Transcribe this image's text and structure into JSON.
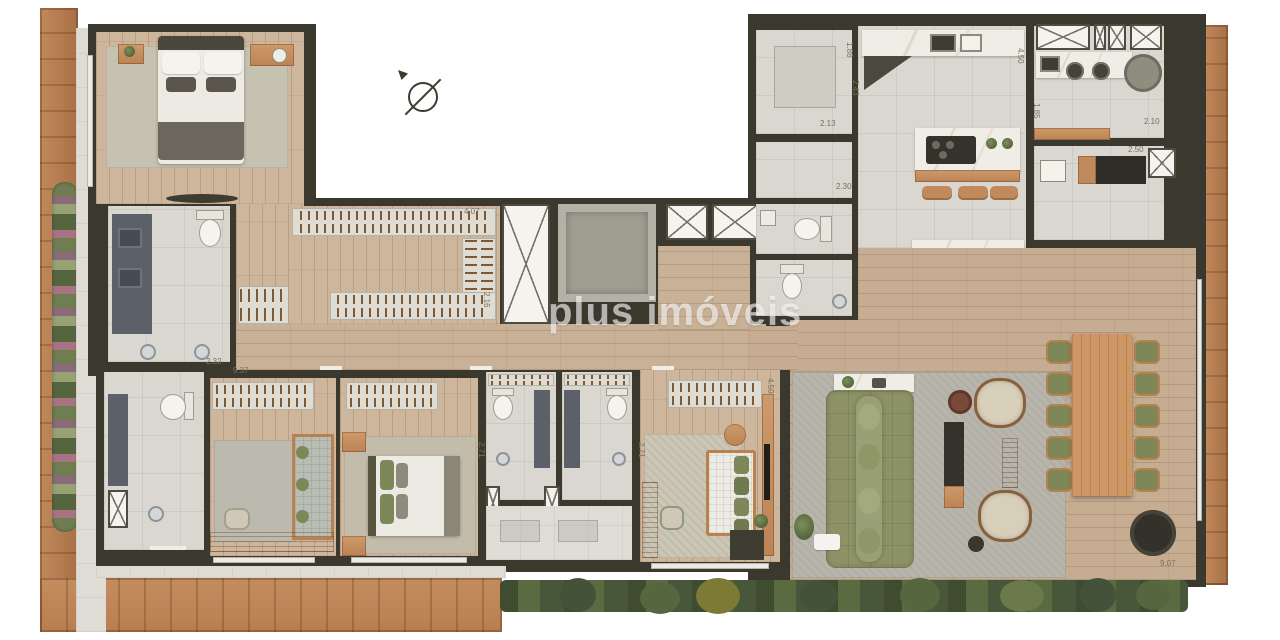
{
  "watermark": {
    "text": "plus imóveis"
  },
  "icons": {
    "north_arrow": "north-arrow"
  },
  "colors": {
    "deck_wood": "#b67c50",
    "wall": "#3b382d",
    "wood_floor": "#cdb69c",
    "tile": "#d9d7cf",
    "sofa_green": "#8d9367",
    "rug_gray": "#b7b5ac",
    "marble": "#efede5",
    "plant_green": "#55663f",
    "watermark_white": "rgba(255,255,255,0.62)"
  },
  "dims": [
    {
      "text": "4.07",
      "x": 464,
      "y": 208,
      "rot": 0
    },
    {
      "text": "2.16",
      "x": 482,
      "y": 292,
      "rot": 90
    },
    {
      "text": "2.32",
      "x": 206,
      "y": 358,
      "rot": 0
    },
    {
      "text": "9.37",
      "x": 233,
      "y": 367,
      "rot": 0
    },
    {
      "text": "2.71",
      "x": 477,
      "y": 442,
      "rot": 90
    },
    {
      "text": "2.71",
      "x": 637,
      "y": 442,
      "rot": 90
    },
    {
      "text": "1.88",
      "x": 845,
      "y": 42,
      "rot": 90
    },
    {
      "text": "2.43",
      "x": 851,
      "y": 80,
      "rot": 90
    },
    {
      "text": "2.13",
      "x": 820,
      "y": 120,
      "rot": 0
    },
    {
      "text": "2.30",
      "x": 836,
      "y": 183,
      "rot": 0
    },
    {
      "text": "4.50",
      "x": 1016,
      "y": 48,
      "rot": 90
    },
    {
      "text": "1.85",
      "x": 1032,
      "y": 103,
      "rot": 90
    },
    {
      "text": "2.10",
      "x": 1144,
      "y": 118,
      "rot": 0
    },
    {
      "text": "2.50",
      "x": 1128,
      "y": 146,
      "rot": 0
    },
    {
      "text": "4.50",
      "x": 766,
      "y": 378,
      "rot": 90
    },
    {
      "text": "9.07",
      "x": 1160,
      "y": 560,
      "rot": 0
    }
  ]
}
